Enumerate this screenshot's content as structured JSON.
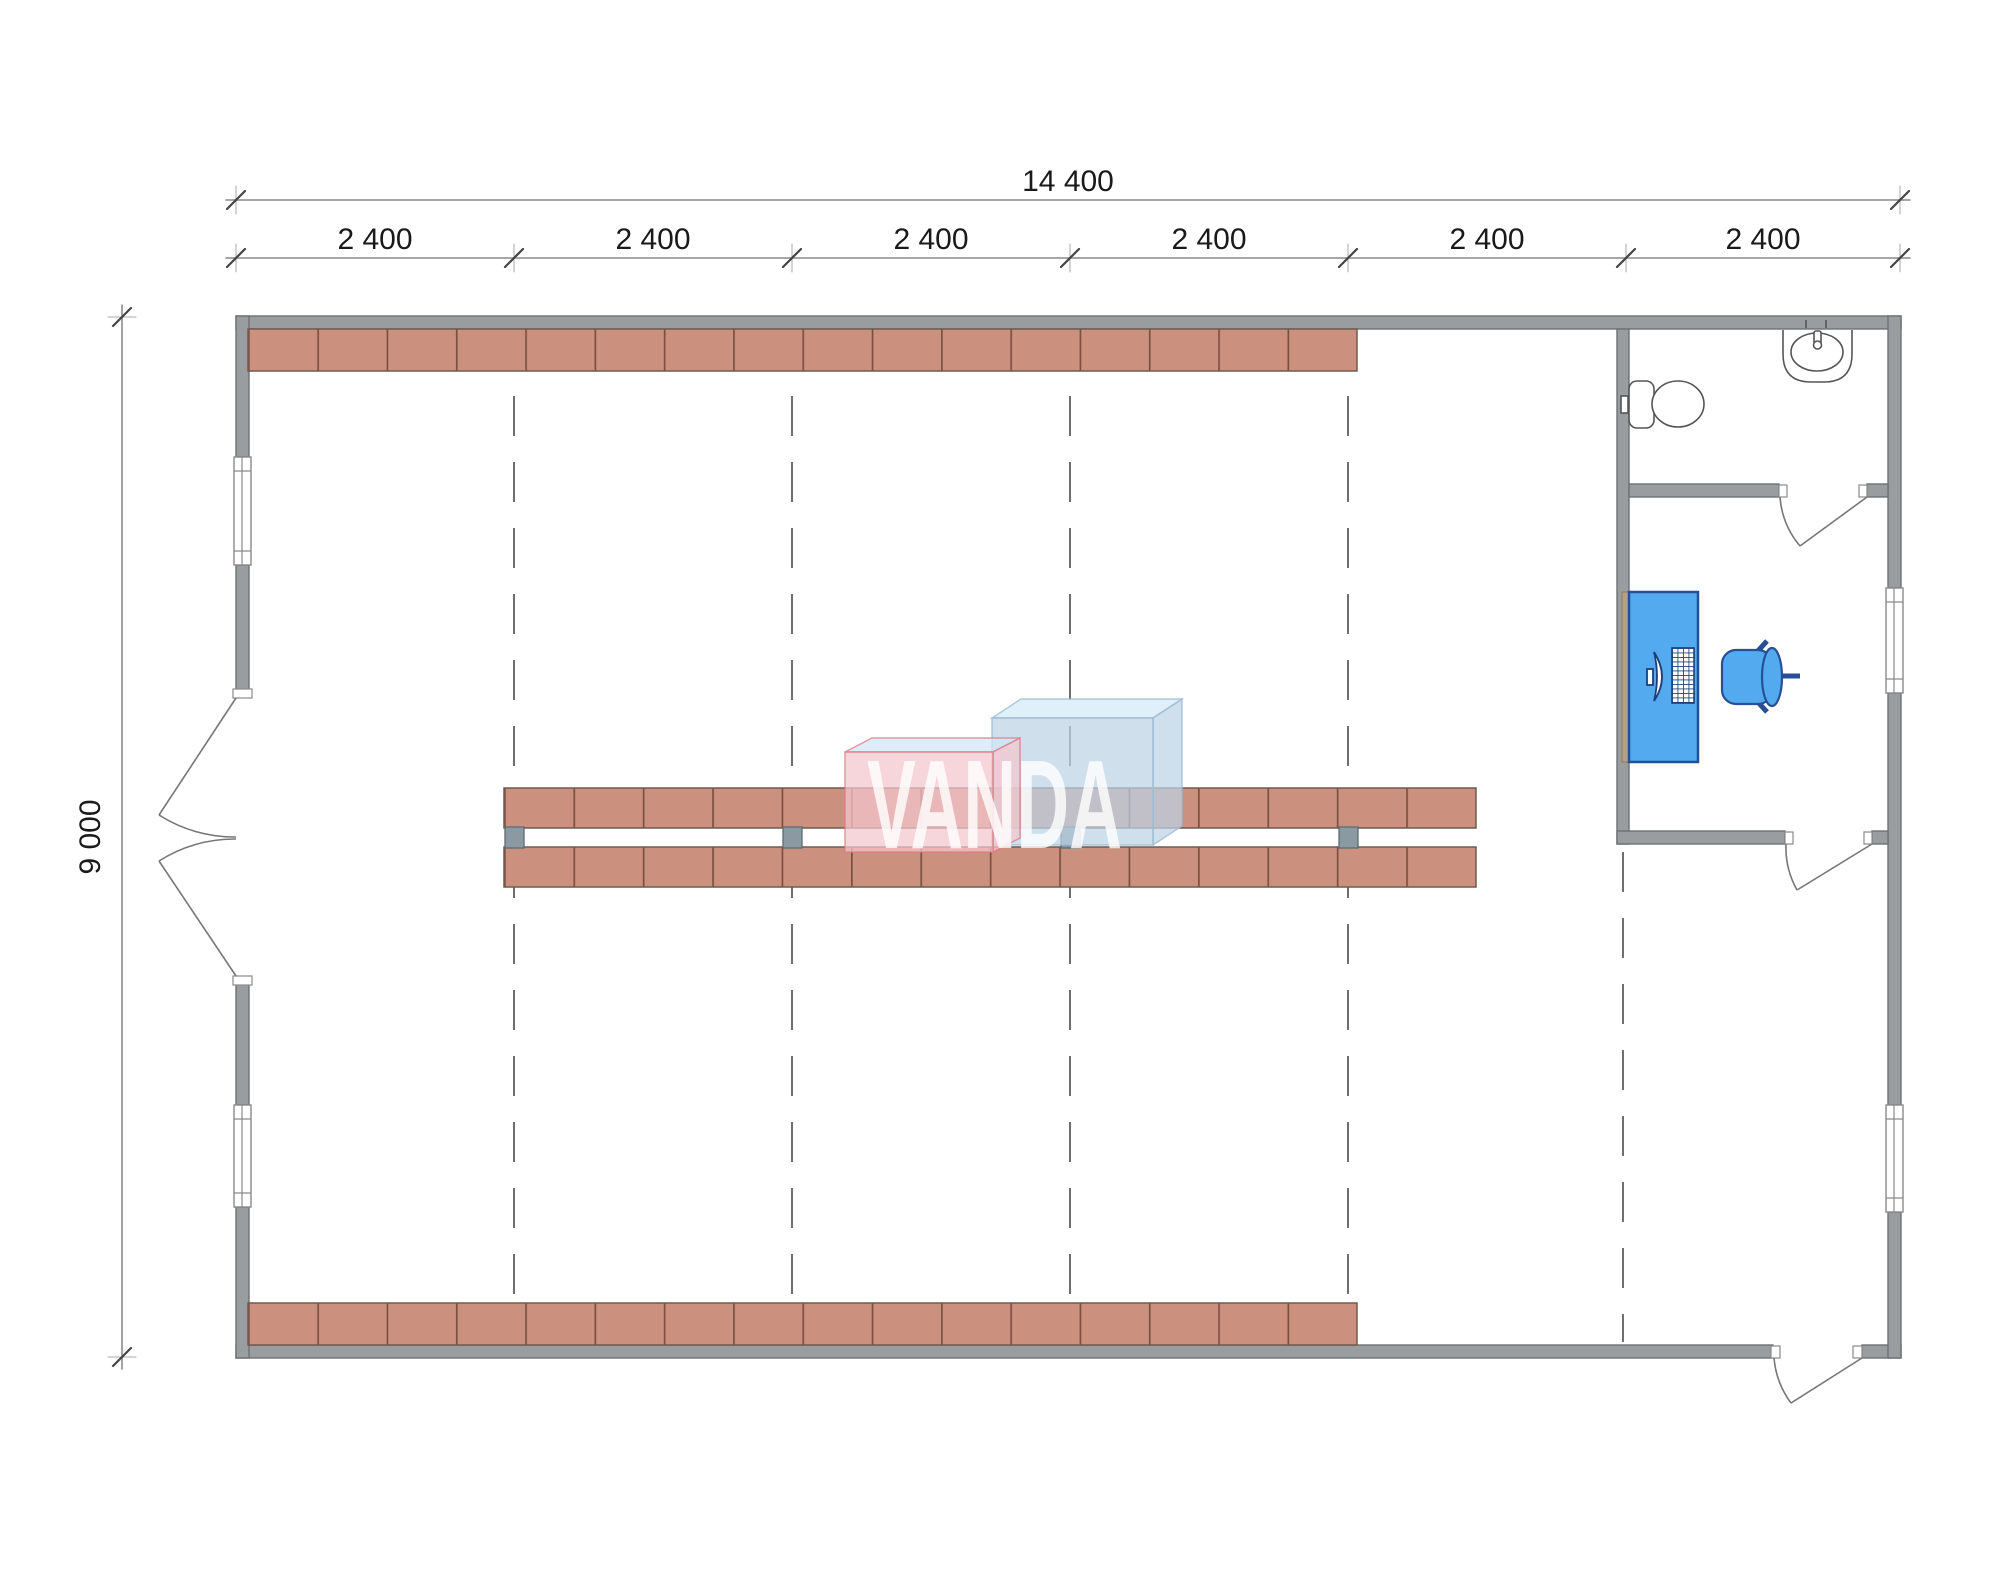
{
  "watermark": {
    "text": "VANDA"
  },
  "dimensions": {
    "total_width": "14 400",
    "total_height": "9 000",
    "bays": [
      "2 400",
      "2 400",
      "2 400",
      "2 400",
      "2 400",
      "2 400"
    ]
  },
  "fixtures": {
    "toilet_icon": "toilet-plan-icon",
    "sink_icon": "sink-plan-icon",
    "desk_icon": "desk-plan-icon",
    "monitor_icon": "monitor-plan-icon",
    "keyboard_icon": "keyboard-plan-icon",
    "chair_icon": "office-chair-plan-icon"
  },
  "colors": {
    "wall": "#9a9da0",
    "wall_edge": "#6e7173",
    "shelf": "#cb917e",
    "shelf_divider": "#7d4f41",
    "shelf_edge": "#6f5b51",
    "post": "#8b9aa2",
    "furniture": "#54aaef",
    "furniture_edge": "#274f96",
    "fixture_line": "#555555",
    "dim_line": "#6f6f6f",
    "dim_text": "#1a1a1a",
    "grid_dash": "#6f6f6f",
    "logo_pink": "#f4c6cd",
    "logo_pink_edge": "#e07a87",
    "logo_pink_top": "#cde7f6",
    "logo_blue": "#bdd2e4",
    "logo_blue_edge": "#9ab9d2",
    "logo_blue_top": "#d2eaf8",
    "logo_text_color": "#ffffff",
    "desk_side": "#b99f86"
  }
}
